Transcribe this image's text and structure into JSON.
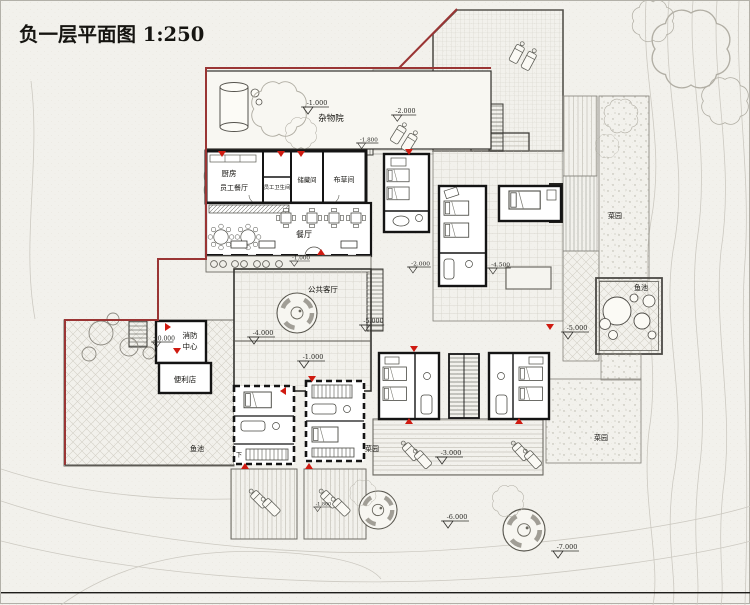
{
  "title": "负一层平面图 1:250",
  "colors": {
    "boundary_red": "#9a3534",
    "marker_red": "#cf1a10",
    "wall_black": "#141414",
    "paper": "#f2f1ec"
  },
  "rooms": {
    "misc_yard": "杂物院",
    "kitchen": "厨房",
    "staff_dining": "员工餐厅",
    "staff_wc": "员工卫生间",
    "storage": "储藏间",
    "linen": "布草间",
    "dining": "餐厅",
    "public_living": "公共客厅",
    "fire1": "消防",
    "fire2": "中心",
    "store": "便利店",
    "down": "下"
  },
  "site": {
    "fish_pond": "鱼池",
    "garden": "菜园"
  },
  "levels": {
    "zero": "±0.000",
    "m1000": "-1.000",
    "m1800": "-1.800",
    "m2000": "-2.000",
    "m3000": "-3.000",
    "m4000": "-4.000",
    "m4500": "-4.500",
    "m5000": "-5.000",
    "m6000": "-6.000",
    "m7000": "-7.000"
  }
}
